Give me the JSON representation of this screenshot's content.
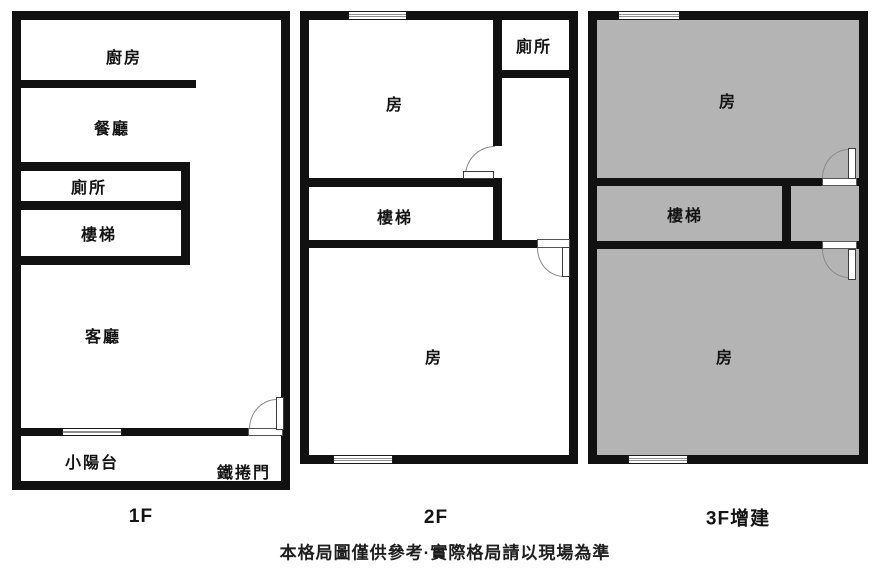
{
  "caption": "本格局圖僅供參考·實際格局請以現場為準",
  "colors": {
    "wall": "#111111",
    "gray_room": "#b4b4b4",
    "background": "#ffffff"
  },
  "floors": [
    {
      "name": "1F",
      "label": "1F",
      "rooms": {
        "kitchen": "廚房",
        "dining": "餐廳",
        "toilet": "廁所",
        "stairs": "樓梯",
        "living": "客廳",
        "balcony": "小陽台",
        "roller_door": "鐵捲門"
      }
    },
    {
      "name": "2F",
      "label": "2F",
      "rooms": {
        "room_top": "房",
        "toilet": "廁所",
        "stairs": "樓梯",
        "room_bottom": "房"
      }
    },
    {
      "name": "3F",
      "label": "3F增建",
      "rooms": {
        "room_top": "房",
        "stairs": "樓梯",
        "room_bottom": "房"
      }
    }
  ]
}
